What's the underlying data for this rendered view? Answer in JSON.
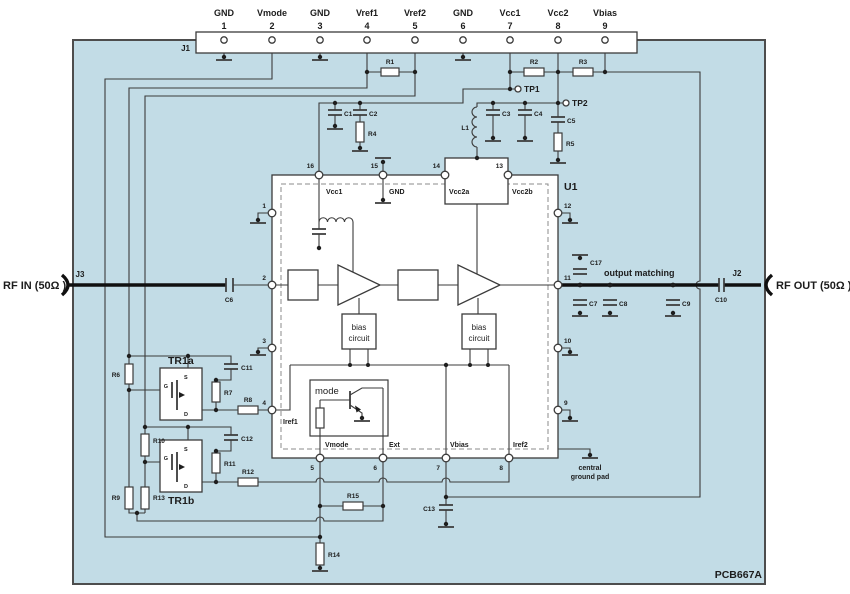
{
  "board_ref": "PCB667A",
  "colors": {
    "board": "#c2dce6",
    "line": "#3b3b3b"
  },
  "connectors": {
    "j1": "J1",
    "j2": "J2",
    "j3": "J3"
  },
  "rf": {
    "in_label": "RF IN (50Ω )",
    "out_label": "RF OUT (50Ω )",
    "output_matching": "output matching"
  },
  "test_points": {
    "tp1": "TP1",
    "tp2": "TP2"
  },
  "j1_pins": [
    {
      "name": "GND",
      "num": "1"
    },
    {
      "name": "Vmode",
      "num": "2"
    },
    {
      "name": "GND",
      "num": "3"
    },
    {
      "name": "Vref1",
      "num": "4"
    },
    {
      "name": "Vref2",
      "num": "5"
    },
    {
      "name": "GND",
      "num": "6"
    },
    {
      "name": "Vcc1",
      "num": "7"
    },
    {
      "name": "Vcc2",
      "num": "8"
    },
    {
      "name": "Vbias",
      "num": "9"
    }
  ],
  "ic": {
    "ref": "U1",
    "pins": {
      "p1": "1",
      "p2": "2",
      "p3": "3",
      "p4": "4",
      "p5": "5",
      "p6": "6",
      "p7": "7",
      "p8": "8",
      "p9": "9",
      "p10": "10",
      "p11": "11",
      "p12": "12",
      "p13": "13",
      "p14": "14",
      "p15": "15",
      "p16": "16"
    },
    "labels": {
      "vcc1": "Vcc1",
      "gnd": "GND",
      "vcc2a": "Vcc2a",
      "vcc2b": "Vcc2b",
      "iref1": "Iref1",
      "vmode": "Vmode",
      "ext": "Ext",
      "vbias": "Vbias",
      "iref2": "Iref2"
    },
    "mode_label": "mode",
    "bias_line1": "bias",
    "bias_line2": "circuit"
  },
  "resistors": {
    "r1": "R1",
    "r2": "R2",
    "r3": "R3",
    "r4": "R4",
    "r5": "R5",
    "r6": "R6",
    "r7": "R7",
    "r8": "R8",
    "r9": "R9",
    "r10": "R10",
    "r11": "R11",
    "r12": "R12",
    "r13": "R13",
    "r14": "R14",
    "r15": "R15"
  },
  "capacitors": {
    "c1": "C1",
    "c2": "C2",
    "c3": "C3",
    "c4": "C4",
    "c5": "C5",
    "c6": "C6",
    "c7": "C7",
    "c8": "C8",
    "c9": "C9",
    "c10": "C10",
    "c11": "C11",
    "c12": "C12",
    "c13": "C13",
    "c17": "C17"
  },
  "inductor": {
    "l1": "L1"
  },
  "transistors": {
    "tr1a": "TR1a",
    "tr1b": "TR1b",
    "gate": "G",
    "source": "S",
    "drain": "D"
  },
  "ground_pad": {
    "line1": "central",
    "line2": "ground pad"
  }
}
